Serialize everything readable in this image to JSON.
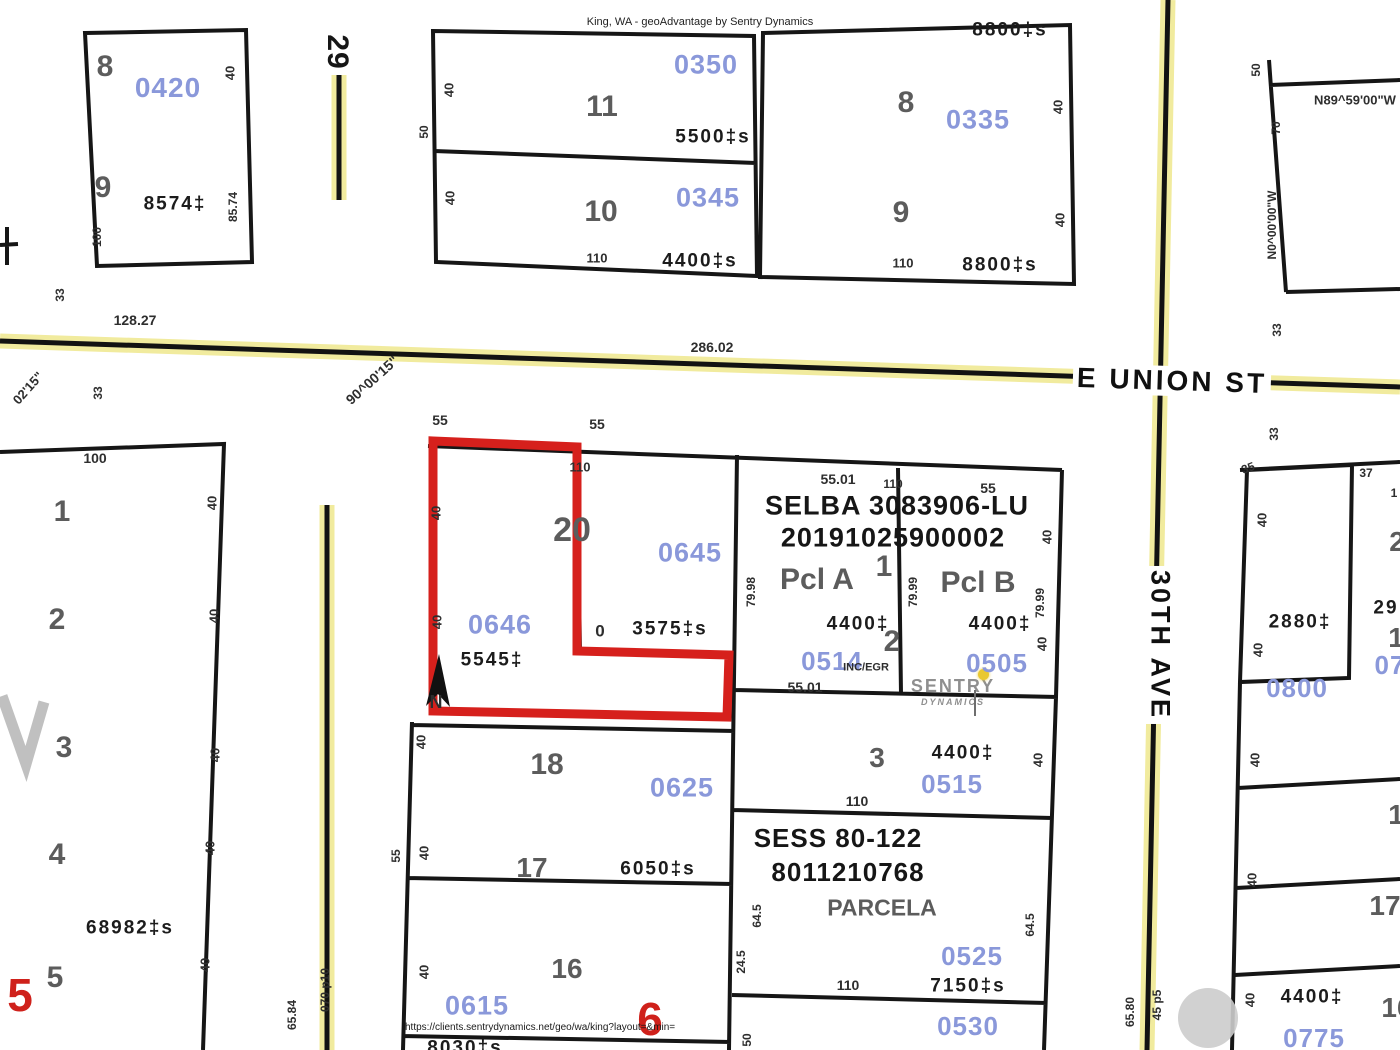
{
  "header": {
    "title": "King, WA - geoAdvantage by Sentry Dynamics"
  },
  "footer": {
    "url": "https://clients.sentrydynamics.net/geo/wa/king?layout=&min="
  },
  "logo": {
    "line1": "SENTRY",
    "line2": "DYNAMICS"
  },
  "streets": {
    "e_union": "E UNION ST",
    "ave_30th": "30TH AVE",
    "road_29": "29"
  },
  "highlight": {
    "parcel_id": "0646",
    "area": "5545‡",
    "outline_color": "#d6201c"
  },
  "colors": {
    "parcel_id_blue": "#8a98da",
    "road_yellow": "#f1eb9e",
    "line_black": "#161616",
    "red": "#cf211b"
  },
  "plats": {
    "selba": [
      "SELBA 3083906-LU",
      "20191025900002"
    ],
    "sess": [
      "SESS 80-122",
      "8011210768"
    ]
  },
  "map_labels": [
    {
      "n": "lot-8-nw",
      "t": "8",
      "x": 105,
      "y": 67,
      "s": 30,
      "r": 0,
      "c": "lot"
    },
    {
      "n": "pid-0420",
      "t": "0420",
      "x": 168,
      "y": 88,
      "s": 28,
      "r": 0,
      "c": "blue"
    },
    {
      "n": "dim-40",
      "t": "40",
      "x": 230,
      "y": 73,
      "s": 13,
      "r": -90,
      "c": "dim"
    },
    {
      "n": "lot-9-nw",
      "t": "9",
      "x": 103,
      "y": 188,
      "s": 30,
      "r": 0,
      "c": "lot"
    },
    {
      "n": "area-8574",
      "t": "8574‡",
      "x": 175,
      "y": 204,
      "s": 19,
      "r": 0,
      "c": "sq"
    },
    {
      "n": "dim-8574",
      "t": "85.74",
      "x": 233,
      "y": 207,
      "s": 12,
      "r": -90,
      "c": "dim"
    },
    {
      "n": "dim-100",
      "t": "100",
      "x": 97,
      "y": 237,
      "s": 12,
      "r": -90,
      "c": "dim"
    },
    {
      "n": "road-29-label",
      "t": "29",
      "x": 337,
      "y": 52,
      "s": 30,
      "r": 90,
      "c": "plat"
    },
    {
      "n": "dim-50",
      "t": "50",
      "x": 424,
      "y": 132,
      "s": 12,
      "r": -90,
      "c": "dim"
    },
    {
      "n": "dim-40",
      "t": "40",
      "x": 449,
      "y": 90,
      "s": 13,
      "r": -90,
      "c": "dim"
    },
    {
      "n": "lot-11",
      "t": "11",
      "x": 602,
      "y": 107,
      "s": 30,
      "r": 0,
      "c": "lot"
    },
    {
      "n": "pid-0350",
      "t": "0350",
      "x": 706,
      "y": 65,
      "s": 27,
      "r": 0,
      "c": "blue"
    },
    {
      "n": "area-5500",
      "t": "5500‡s",
      "x": 713,
      "y": 137,
      "s": 19,
      "r": 0,
      "c": "sq"
    },
    {
      "n": "dim-40",
      "t": "40",
      "x": 450,
      "y": 198,
      "s": 13,
      "r": -90,
      "c": "dim"
    },
    {
      "n": "lot-10",
      "t": "10",
      "x": 601,
      "y": 212,
      "s": 30,
      "r": 0,
      "c": "lot"
    },
    {
      "n": "pid-0345",
      "t": "0345",
      "x": 708,
      "y": 198,
      "s": 27,
      "r": 0,
      "c": "blue"
    },
    {
      "n": "dim-110",
      "t": "110",
      "x": 597,
      "y": 258,
      "s": 13,
      "r": 0,
      "c": "dim"
    },
    {
      "n": "area-4400s",
      "t": "4400‡s",
      "x": 700,
      "y": 261,
      "s": 19,
      "r": 0,
      "c": "sq"
    },
    {
      "n": "area-8800-top",
      "t": "8800‡s",
      "x": 1010,
      "y": 30,
      "s": 19,
      "r": 0,
      "c": "sq"
    },
    {
      "n": "lot-8-ne",
      "t": "8",
      "x": 906,
      "y": 103,
      "s": 30,
      "r": 0,
      "c": "lot"
    },
    {
      "n": "pid-0335",
      "t": "0335",
      "x": 978,
      "y": 120,
      "s": 27,
      "r": 0,
      "c": "blue"
    },
    {
      "n": "dim-40",
      "t": "40",
      "x": 1058,
      "y": 107,
      "s": 13,
      "r": -90,
      "c": "dim"
    },
    {
      "n": "lot-9-ne",
      "t": "9",
      "x": 901,
      "y": 213,
      "s": 30,
      "r": 0,
      "c": "lot"
    },
    {
      "n": "dim-40",
      "t": "40",
      "x": 1060,
      "y": 220,
      "s": 13,
      "r": -90,
      "c": "dim"
    },
    {
      "n": "dim-110",
      "t": "110",
      "x": 903,
      "y": 263,
      "s": 13,
      "r": 0,
      "c": "dim"
    },
    {
      "n": "area-8800",
      "t": "8800‡s",
      "x": 1000,
      "y": 265,
      "s": 19,
      "r": 0,
      "c": "sq"
    },
    {
      "n": "dim-50",
      "t": "50",
      "x": 1256,
      "y": 70,
      "s": 12,
      "r": -90,
      "c": "dim"
    },
    {
      "n": "bearing-n89",
      "t": "N89^59'00\"W",
      "x": 1355,
      "y": 100,
      "s": 13,
      "r": 0,
      "c": "dim"
    },
    {
      "n": "dim-70",
      "t": "70",
      "x": 1276,
      "y": 128,
      "s": 12,
      "r": -90,
      "c": "dim"
    },
    {
      "n": "bearing-n0",
      "t": "N0^00'00\"W",
      "x": 1272,
      "y": 225,
      "s": 12,
      "r": -90,
      "c": "dim"
    },
    {
      "n": "dim-33",
      "t": "33",
      "x": 1277,
      "y": 330,
      "s": 12,
      "r": -90,
      "c": "dim"
    },
    {
      "n": "dim-12827",
      "t": "128.27",
      "x": 135,
      "y": 320,
      "s": 14,
      "r": 0,
      "c": "dim"
    },
    {
      "n": "bearing-0215",
      "t": "02'15\"",
      "x": 28,
      "y": 388,
      "s": 13,
      "r": -48,
      "c": "dim"
    },
    {
      "n": "dim-33",
      "t": "33",
      "x": 60,
      "y": 295,
      "s": 12,
      "r": -90,
      "c": "dim"
    },
    {
      "n": "dim-33",
      "t": "33",
      "x": 98,
      "y": 393,
      "s": 12,
      "r": -90,
      "c": "dim"
    },
    {
      "n": "dim-28602",
      "t": "286.02",
      "x": 712,
      "y": 347,
      "s": 14,
      "r": 0,
      "c": "dim"
    },
    {
      "n": "bearing-900015",
      "t": "90^00'15\"",
      "x": 372,
      "y": 380,
      "s": 14,
      "r": -42,
      "c": "dim"
    },
    {
      "n": "street-e-union-st",
      "t": "E UNION ST",
      "x": 1172,
      "y": 381,
      "s": 28,
      "r": 1.8,
      "c": "street"
    },
    {
      "n": "dim-33",
      "t": "33",
      "x": 1274,
      "y": 434,
      "s": 12,
      "r": -90,
      "c": "dim"
    },
    {
      "n": "street-30th-ave",
      "t": "30TH AVE",
      "x": 1160,
      "y": 645,
      "s": 27,
      "r": 90,
      "c": "street"
    },
    {
      "n": "dim-100",
      "t": "100",
      "x": 95,
      "y": 458,
      "s": 14,
      "r": 0,
      "c": "dim"
    },
    {
      "n": "lot-1",
      "t": "1",
      "x": 62,
      "y": 512,
      "s": 30,
      "r": 0,
      "c": "lot"
    },
    {
      "n": "dim-40",
      "t": "40",
      "x": 212,
      "y": 503,
      "s": 13,
      "r": -90,
      "c": "dim"
    },
    {
      "n": "lot-2",
      "t": "2",
      "x": 57,
      "y": 620,
      "s": 30,
      "r": 0,
      "c": "lot"
    },
    {
      "n": "dim-40",
      "t": "40",
      "x": 214,
      "y": 616,
      "s": 13,
      "r": -90,
      "c": "dim"
    },
    {
      "n": "lot-3-w",
      "t": "3",
      "x": 64,
      "y": 748,
      "s": 30,
      "r": 0,
      "c": "lot"
    },
    {
      "n": "dim-40",
      "t": "40",
      "x": 215,
      "y": 755,
      "s": 13,
      "r": -90,
      "c": "dim"
    },
    {
      "n": "lot-4",
      "t": "4",
      "x": 57,
      "y": 855,
      "s": 30,
      "r": 0,
      "c": "lot"
    },
    {
      "n": "dim-40",
      "t": "40",
      "x": 210,
      "y": 848,
      "s": 13,
      "r": -90,
      "c": "dim"
    },
    {
      "n": "area-68982",
      "t": "68982‡s",
      "x": 130,
      "y": 928,
      "s": 19,
      "r": 0,
      "c": "sq"
    },
    {
      "n": "lot-5",
      "t": "5",
      "x": 55,
      "y": 978,
      "s": 30,
      "r": 0,
      "c": "lot"
    },
    {
      "n": "dim-40",
      "t": "40",
      "x": 205,
      "y": 965,
      "s": 13,
      "r": -90,
      "c": "dim"
    },
    {
      "n": "block-5-red",
      "t": "5",
      "x": 20,
      "y": 995,
      "s": 46,
      "r": 0,
      "c": "red"
    },
    {
      "n": "dim-55",
      "t": "55",
      "x": 440,
      "y": 420,
      "s": 14,
      "r": 0,
      "c": "dim"
    },
    {
      "n": "dim-55",
      "t": "55",
      "x": 597,
      "y": 424,
      "s": 14,
      "r": 0,
      "c": "dim"
    },
    {
      "n": "dim-110",
      "t": "110",
      "x": 580,
      "y": 467,
      "s": 13,
      "r": 0,
      "c": "dim"
    },
    {
      "n": "dim-40",
      "t": "40",
      "x": 436,
      "y": 513,
      "s": 13,
      "r": -90,
      "c": "dim"
    },
    {
      "n": "lot-20",
      "t": "20",
      "x": 572,
      "y": 530,
      "s": 34,
      "r": 0,
      "c": "lot"
    },
    {
      "n": "pid-0645",
      "t": "0645",
      "x": 690,
      "y": 553,
      "s": 27,
      "r": 0,
      "c": "blue"
    },
    {
      "n": "dim-40",
      "t": "40",
      "x": 437,
      "y": 622,
      "s": 13,
      "r": -90,
      "c": "dim"
    },
    {
      "n": "pid-0646",
      "t": "0646",
      "x": 500,
      "y": 625,
      "s": 27,
      "r": 0,
      "c": "blue"
    },
    {
      "n": "area-3575",
      "t": "3575‡s",
      "x": 670,
      "y": 629,
      "s": 19,
      "r": 0,
      "c": "sq"
    },
    {
      "n": "dim-110-frag",
      "t": "0",
      "x": 600,
      "y": 631,
      "s": 17,
      "r": 0,
      "c": "dim"
    },
    {
      "n": "area-5545",
      "t": "5545‡",
      "x": 492,
      "y": 660,
      "s": 19,
      "r": 0,
      "c": "sq"
    },
    {
      "n": "north-n",
      "t": "N",
      "x": 436,
      "y": 702,
      "s": 18,
      "r": 0,
      "c": "dim"
    },
    {
      "n": "dim-5501",
      "t": "55.01",
      "x": 838,
      "y": 479,
      "s": 14,
      "r": 0,
      "c": "dim"
    },
    {
      "n": "dim-110",
      "t": "110",
      "x": 893,
      "y": 484,
      "s": 12,
      "r": 0,
      "c": "dim"
    },
    {
      "n": "dim-55",
      "t": "55",
      "x": 988,
      "y": 488,
      "s": 14,
      "r": 0,
      "c": "dim"
    },
    {
      "n": "plat-selba-1",
      "t": "SELBA 3083906-LU",
      "x": 897,
      "y": 506,
      "s": 27,
      "r": 0,
      "c": "plat"
    },
    {
      "n": "plat-selba-2",
      "t": "20191025900002",
      "x": 893,
      "y": 538,
      "s": 27,
      "r": 0,
      "c": "plat"
    },
    {
      "n": "dim-7998",
      "t": "79.98",
      "x": 751,
      "y": 592,
      "s": 12,
      "r": -90,
      "c": "dim"
    },
    {
      "n": "pcl-a",
      "t": "Pcl A",
      "x": 817,
      "y": 580,
      "s": 30,
      "r": 0,
      "c": "lot"
    },
    {
      "n": "lot-1-selba",
      "t": "1",
      "x": 884,
      "y": 567,
      "s": 30,
      "r": 0,
      "c": "lot"
    },
    {
      "n": "dim-7999",
      "t": "79.99",
      "x": 913,
      "y": 592,
      "s": 12,
      "r": -90,
      "c": "dim"
    },
    {
      "n": "pcl-b",
      "t": "Pcl B",
      "x": 978,
      "y": 583,
      "s": 30,
      "r": 0,
      "c": "lot"
    },
    {
      "n": "dim-40",
      "t": "40",
      "x": 1047,
      "y": 537,
      "s": 13,
      "r": -90,
      "c": "dim"
    },
    {
      "n": "dim-7999",
      "t": "79.99",
      "x": 1040,
      "y": 603,
      "s": 12,
      "r": -90,
      "c": "dim"
    },
    {
      "n": "area-4400-a",
      "t": "4400‡",
      "x": 858,
      "y": 624,
      "s": 19,
      "r": 0,
      "c": "sq"
    },
    {
      "n": "lot-2-selba",
      "t": "2",
      "x": 892,
      "y": 642,
      "s": 30,
      "r": 0,
      "c": "lot"
    },
    {
      "n": "pid-0514",
      "t": "0514",
      "x": 832,
      "y": 661,
      "s": 26,
      "r": 0,
      "c": "blue"
    },
    {
      "n": "note-inc-egr",
      "t": "INC/EGR",
      "x": 866,
      "y": 668,
      "s": 11,
      "r": 0,
      "c": "dim"
    },
    {
      "n": "dim-5501",
      "t": "55.01",
      "x": 805,
      "y": 687,
      "s": 14,
      "r": 0,
      "c": "dim"
    },
    {
      "n": "area-4400-b",
      "t": "4400‡",
      "x": 1000,
      "y": 624,
      "s": 19,
      "r": 0,
      "c": "sq"
    },
    {
      "n": "dim-40",
      "t": "40",
      "x": 1042,
      "y": 644,
      "s": 13,
      "r": -90,
      "c": "dim"
    },
    {
      "n": "pid-0505",
      "t": "0505",
      "x": 997,
      "y": 663,
      "s": 26,
      "r": 0,
      "c": "blue"
    },
    {
      "n": "lot-3-e",
      "t": "3",
      "x": 877,
      "y": 758,
      "s": 28,
      "r": 0,
      "c": "lot"
    },
    {
      "n": "area-4400-c",
      "t": "4400‡",
      "x": 963,
      "y": 753,
      "s": 19,
      "r": 0,
      "c": "sq"
    },
    {
      "n": "pid-0515",
      "t": "0515",
      "x": 952,
      "y": 784,
      "s": 26,
      "r": 0,
      "c": "blue"
    },
    {
      "n": "dim-40",
      "t": "40",
      "x": 1038,
      "y": 760,
      "s": 13,
      "r": -90,
      "c": "dim"
    },
    {
      "n": "dim-110",
      "t": "110",
      "x": 857,
      "y": 801,
      "s": 14,
      "r": 0,
      "c": "dim"
    },
    {
      "n": "plat-sess-1",
      "t": "SESS 80-122",
      "x": 838,
      "y": 838,
      "s": 26,
      "r": 0,
      "c": "plat"
    },
    {
      "n": "plat-sess-2",
      "t": "8011210768",
      "x": 848,
      "y": 872,
      "s": 26,
      "r": 0,
      "c": "plat"
    },
    {
      "n": "dim-645",
      "t": "64.5",
      "x": 757,
      "y": 916,
      "s": 12,
      "r": -90,
      "c": "dim"
    },
    {
      "n": "parcel-a-label",
      "t": "PARCELA",
      "x": 882,
      "y": 908,
      "s": 23,
      "r": 0,
      "c": "lot"
    },
    {
      "n": "dim-645",
      "t": "64.5",
      "x": 1030,
      "y": 925,
      "s": 12,
      "r": -90,
      "c": "dim"
    },
    {
      "n": "dim-245",
      "t": "24.5",
      "x": 741,
      "y": 962,
      "s": 12,
      "r": -90,
      "c": "dim"
    },
    {
      "n": "pid-0525",
      "t": "0525",
      "x": 972,
      "y": 956,
      "s": 26,
      "r": 0,
      "c": "blue"
    },
    {
      "n": "dim-110",
      "t": "110",
      "x": 848,
      "y": 985,
      "s": 14,
      "r": 0,
      "c": "dim"
    },
    {
      "n": "area-7150",
      "t": "7150‡s",
      "x": 968,
      "y": 986,
      "s": 19,
      "r": 0,
      "c": "sq"
    },
    {
      "n": "pid-0530",
      "t": "0530",
      "x": 968,
      "y": 1026,
      "s": 26,
      "r": 0,
      "c": "blue"
    },
    {
      "n": "dim-40",
      "t": "40",
      "x": 421,
      "y": 742,
      "s": 13,
      "r": -90,
      "c": "dim"
    },
    {
      "n": "lot-18",
      "t": "18",
      "x": 547,
      "y": 765,
      "s": 30,
      "r": 0,
      "c": "lot"
    },
    {
      "n": "pid-0625",
      "t": "0625",
      "x": 682,
      "y": 788,
      "s": 27,
      "r": 0,
      "c": "blue"
    },
    {
      "n": "dim-55",
      "t": "55",
      "x": 396,
      "y": 856,
      "s": 12,
      "r": -90,
      "c": "dim"
    },
    {
      "n": "dim-40",
      "t": "40",
      "x": 424,
      "y": 853,
      "s": 13,
      "r": -90,
      "c": "dim"
    },
    {
      "n": "lot-17",
      "t": "17",
      "x": 532,
      "y": 868,
      "s": 28,
      "r": 0,
      "c": "lot"
    },
    {
      "n": "area-6050",
      "t": "6050‡s",
      "x": 658,
      "y": 869,
      "s": 19,
      "r": 0,
      "c": "sq"
    },
    {
      "n": "dim-40",
      "t": "40",
      "x": 424,
      "y": 972,
      "s": 13,
      "r": -90,
      "c": "dim"
    },
    {
      "n": "lot-16",
      "t": "16",
      "x": 567,
      "y": 969,
      "s": 28,
      "r": 0,
      "c": "lot"
    },
    {
      "n": "pid-0615",
      "t": "0615",
      "x": 477,
      "y": 1006,
      "s": 27,
      "r": 0,
      "c": "blue"
    },
    {
      "n": "block-6-red",
      "t": "6",
      "x": 650,
      "y": 1019,
      "s": 46,
      "r": 0,
      "c": "red"
    },
    {
      "n": "area-8030",
      "t": "8030‡s",
      "x": 465,
      "y": 1048,
      "s": 19,
      "r": 0,
      "c": "sq"
    },
    {
      "n": "dim-50",
      "t": "50",
      "x": 747,
      "y": 1040,
      "s": 12,
      "r": -90,
      "c": "dim"
    },
    {
      "n": "dim-35",
      "t": "35",
      "x": 1248,
      "y": 468,
      "s": 12,
      "r": -20,
      "c": "dim"
    },
    {
      "n": "dim-37",
      "t": "37",
      "x": 1366,
      "y": 473,
      "s": 12,
      "r": 0,
      "c": "dim"
    },
    {
      "n": "dim-40",
      "t": "40",
      "x": 1262,
      "y": 520,
      "s": 13,
      "r": -90,
      "c": "dim"
    },
    {
      "n": "area-2880",
      "t": "2880‡",
      "x": 1300,
      "y": 622,
      "s": 19,
      "r": 0,
      "c": "sq"
    },
    {
      "n": "dim-40",
      "t": "40",
      "x": 1258,
      "y": 650,
      "s": 13,
      "r": -90,
      "c": "dim"
    },
    {
      "n": "pid-0800",
      "t": "0800",
      "x": 1297,
      "y": 688,
      "s": 26,
      "r": 0,
      "c": "blue"
    },
    {
      "n": "dim-1-frag",
      "t": "1",
      "x": 1394,
      "y": 493,
      "s": 12,
      "r": 0,
      "c": "dim"
    },
    {
      "n": "lot-2-frag",
      "t": "2",
      "x": 1397,
      "y": 542,
      "s": 28,
      "r": 0,
      "c": "lot"
    },
    {
      "n": "area-29-frag",
      "t": "29",
      "x": 1386,
      "y": 608,
      "s": 19,
      "r": 0,
      "c": "sq"
    },
    {
      "n": "lot-1-frag",
      "t": "1",
      "x": 1396,
      "y": 638,
      "s": 28,
      "r": 0,
      "c": "lot"
    },
    {
      "n": "pid-07-frag",
      "t": "07",
      "x": 1390,
      "y": 665,
      "s": 26,
      "r": 0,
      "c": "blue"
    },
    {
      "n": "dim-40",
      "t": "40",
      "x": 1255,
      "y": 760,
      "s": 13,
      "r": -90,
      "c": "dim"
    },
    {
      "n": "lot-1-frag2",
      "t": "1",
      "x": 1396,
      "y": 815,
      "s": 28,
      "r": 0,
      "c": "lot"
    },
    {
      "n": "dim-40",
      "t": "40",
      "x": 1252,
      "y": 880,
      "s": 13,
      "r": -90,
      "c": "dim"
    },
    {
      "n": "lot-17-frag",
      "t": "17",
      "x": 1385,
      "y": 906,
      "s": 28,
      "r": 0,
      "c": "lot"
    },
    {
      "n": "dim-40",
      "t": "40",
      "x": 1250,
      "y": 1000,
      "s": 13,
      "r": -90,
      "c": "dim"
    },
    {
      "n": "area-4400-d",
      "t": "4400‡",
      "x": 1312,
      "y": 997,
      "s": 19,
      "r": 0,
      "c": "sq"
    },
    {
      "n": "pid-0775",
      "t": "0775",
      "x": 1314,
      "y": 1038,
      "s": 26,
      "r": 0,
      "c": "blue"
    },
    {
      "n": "lot-16-frag",
      "t": "16",
      "x": 1397,
      "y": 1008,
      "s": 28,
      "r": 0,
      "c": "lot"
    },
    {
      "n": "dim-6584",
      "t": "65.84",
      "x": 292,
      "y": 1015,
      "s": 12,
      "r": -90,
      "c": "dim"
    },
    {
      "n": "dim-070p10",
      "t": "070 p10",
      "x": 325,
      "y": 990,
      "s": 12,
      "r": -90,
      "c": "dim"
    },
    {
      "n": "dim-6580",
      "t": "65.80",
      "x": 1130,
      "y": 1012,
      "s": 12,
      "r": -90,
      "c": "dim"
    },
    {
      "n": "dim-45p5",
      "t": "45 p5",
      "x": 1157,
      "y": 1005,
      "s": 12,
      "r": -90,
      "c": "dim"
    }
  ]
}
